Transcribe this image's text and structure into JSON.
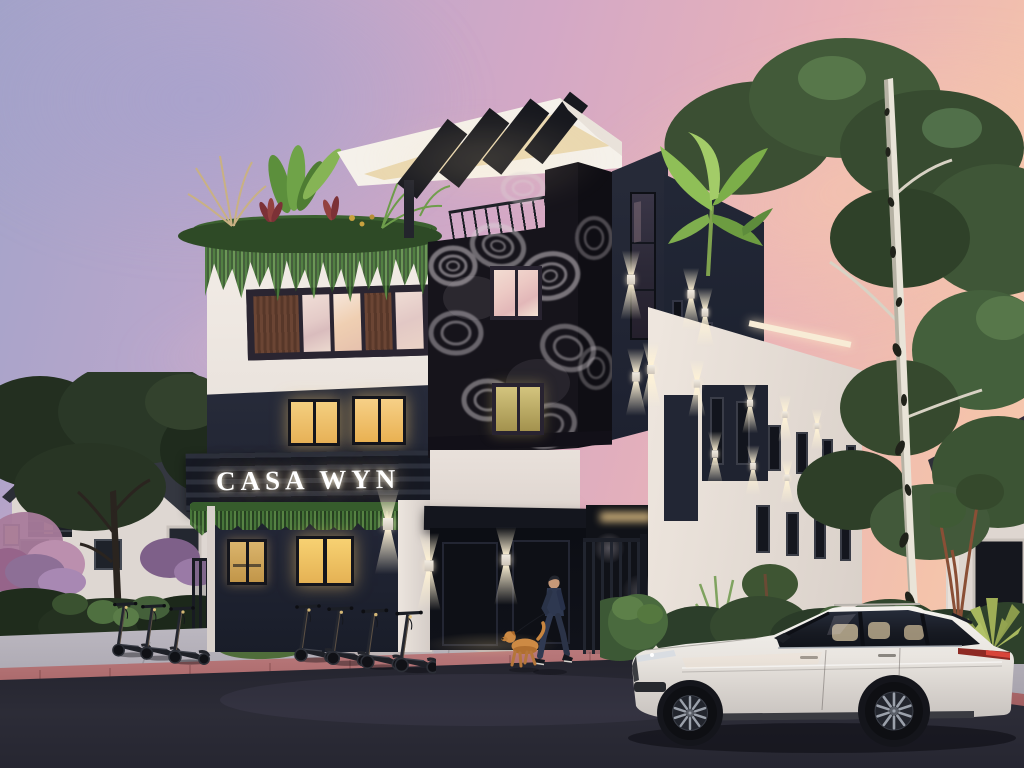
{
  "scene": {
    "description": "Dusk architectural rendering of a modern three-story corner apartment building",
    "sign": {
      "text": "CASA WYN"
    },
    "sky": {
      "left": "#a3a3c9",
      "middle": "#e0adc2",
      "right": "#f6c9ac"
    },
    "palette": {
      "facade_white": "#ece5de",
      "facade_navy": "#232734",
      "mural_black": "#16141b",
      "window_glow": "#f2c96e",
      "sconce_light": "#ffe9c4",
      "greenery": "#44603a",
      "road": "#282933",
      "sidewalk": "#b5b1ba",
      "curb_brick": "#b26b6d",
      "suv_body": "#eae7e2"
    },
    "objects": {
      "building": {
        "name": "Casa Wyn",
        "floors": 3,
        "features": [
          "illuminated serif sign",
          "rooftop pergola with louvers",
          "roof garden with tropical plants",
          "trailing ivy planters",
          "black-and-white floral mural feature wall",
          "up-down exterior sconces",
          "dark navy accent panels"
        ]
      },
      "vehicle": {
        "type": "SUV",
        "color": "white",
        "position": "parked at curb, foreground right"
      },
      "scooters": {
        "count": 7,
        "arrangement": "two rows parked on sidewalk"
      },
      "pedestrian": {
        "description": "man in dark jacket walking a tan dog"
      },
      "neighbor_left": "gabled house with lit windows",
      "neighbor_right": "house behind birch tree",
      "trees": [
        "white birch",
        "large leafy canopy top right",
        "dark trees left",
        "banana plants on roof"
      ]
    }
  }
}
